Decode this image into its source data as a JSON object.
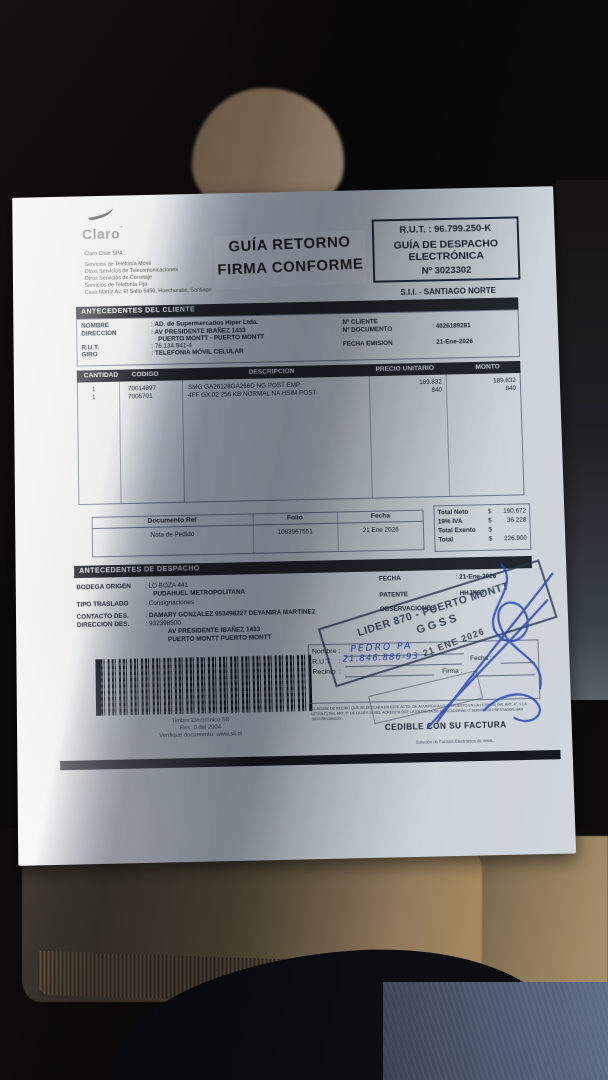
{
  "misc": {
    "colon": ":"
  },
  "supplier": {
    "logo": "Claro",
    "company_lines": [
      "Claro Chile SPA.",
      "Servicios de Telefonía Móvil",
      "Otros Servicios de Telecomunicaciones",
      "Otros Servicios de Corretaje",
      "Servicios de Telefonía Fija",
      "Casa Matriz Av. El Salto 5450, Huechuraba, Santiago"
    ]
  },
  "return_stamp": {
    "line1": "GUÍA RETORNO",
    "line2": "FIRMA CONFORME"
  },
  "rut_box": {
    "rut": "R.U.T. : 96.799.250-K",
    "type_line1": "GUÍA DE DESPACHO",
    "type_line2": "ELECTRÓNICA",
    "number": "Nº 3023302",
    "office": "S.I.I. - SANTIAGO NORTE"
  },
  "client": {
    "title": "ANTECEDENTES DEL CLIENTE",
    "labels": {
      "nombre": "NOMBRE",
      "direccion": "DIRECCION",
      "rut": "R.U.T.",
      "giro": "GIRO",
      "n_cliente": "Nº CLIENTE",
      "n_documento": "Nº DOCUMENTO",
      "fecha_emision": "FECHA EMISION"
    },
    "values": {
      "nombre": "AD. de Supermercados Hiper Ltda.",
      "direccion1": "AV PRESIDENTE IBAÑEZ 1433",
      "direccion2": "PUERTO MONTT -  PUERTO MONTT",
      "rut": "76.134.941-4",
      "giro": "TELEFONIA MÓVIL CELULAR",
      "n_documento": "4026189281",
      "fecha_emision": "21-Ene-2026"
    }
  },
  "items": {
    "headers": [
      "CANTIDAD",
      "CODIGO",
      "DESCRIPCION",
      "PRECIO UNITARIO",
      "MONTO"
    ],
    "rows": [
      {
        "cantidad": "1",
        "codigo": "70014897",
        "descripcion": "SMG GA26128GA266D NG POST EMP",
        "precio": "189.832",
        "monto": "189.832"
      },
      {
        "cantidad": "1",
        "codigo": "7005701",
        "descripcion": "4FF GX.02 256 KB NORMAL NA HSIM POST",
        "precio": "840",
        "monto": "840"
      }
    ]
  },
  "reference": {
    "headers": {
      "doc": "Documento Ref",
      "folio": "Folio",
      "fecha": "Fecha"
    },
    "values": {
      "doc": "Nota de Pedido",
      "folio": "1083967551",
      "fecha": "21 Ene 2026"
    }
  },
  "totals": {
    "rows": [
      {
        "label": "Total Neto",
        "sign": "$",
        "value": "190.672"
      },
      {
        "label": "19% IVA",
        "sign": "$",
        "value": "36.228"
      },
      {
        "label": "Total Exento",
        "sign": "$",
        "value": ""
      },
      {
        "label": "Total",
        "sign": "$",
        "value": "226.900"
      }
    ]
  },
  "dispatch": {
    "title": "ANTECEDENTES DE DESPACHO",
    "labels": {
      "bodega": "BODEGA ORIGEN",
      "tipo": "TIPO TRASLADO",
      "contacto": "CONTACTO DES.",
      "direccion": "DIRECCION DES.",
      "fecha": "FECHA",
      "patente": "PATENTE",
      "observaciones": "OBSERVACIONES"
    },
    "values": {
      "bodega1": "LO BOZA 441",
      "bodega2": "PUDAHUEL  METROPOLITANA",
      "tipo": "Consignaciones",
      "contacto": "DAMARY GONZALEZ 953498227 DEYANIRA MARTINEZ",
      "direccion1": "932398500",
      "direccion2": "AV PRESIDENTE IBAÑEZ 1433",
      "direccion3": "PUERTO MONTT   PUERTO MONTT",
      "fecha": "21-Ene-2026",
      "patente": "HHJK63"
    }
  },
  "timbre": {
    "line1": "Timbre Electrónico SII",
    "line2": "Res. 0 del 2004",
    "line3": "Verifique documento: www.sii.cl"
  },
  "reception": {
    "labels": {
      "nombre": "Nombre",
      "rut": "R.U.T",
      "recinto": "Recinto",
      "fecha": "Fecha :",
      "firma": "Firma :"
    },
    "handwriting": {
      "nombre": "PEDRO  PA",
      "rut": "21.846.886-93"
    },
    "fine_print": [
      "EL ACUSE DE RECIBO QUE SE DECLARA EN ESTE ACTO, DE ACUERDO A LO DISPUESTO EN LA LETRA B) DEL ART. 4°, Y LA",
      "LETRA C) DEL ART. 5° DE LA LEY 19.983, ACREDITA QUE LA ENTREGA DE MERCADERIAS O SERVICIOS PRESTADOS HAN",
      "SIDO RECIBIDOS."
    ],
    "cedible": "CEDIBLE CON SU FACTURA",
    "footer_note": "Solución de Factura Electrónica de www..."
  },
  "stamps": {
    "lider_line1": "LIDER 870 - PUERTO MONTT",
    "lider_line2": "GGSS",
    "date": "21 ENE 2026"
  },
  "colors": {
    "paper": "#eceeec",
    "shadow_blue": "#8b9cb6",
    "bar_dark": "#262b31",
    "pen_blue": "#2d4fc0"
  }
}
